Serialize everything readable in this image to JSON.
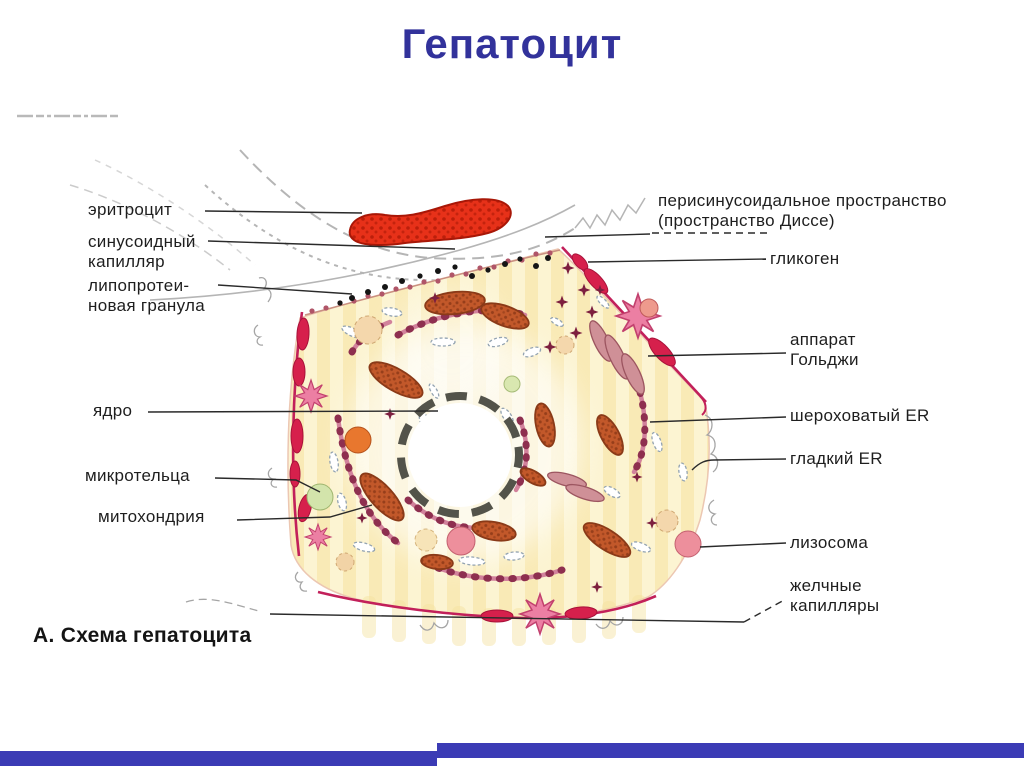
{
  "title": "Гепатоцит",
  "caption": "А. Схема гепатоцита",
  "labels": {
    "erythrocyte": "эритроцит",
    "sinusoid_capillary": "синусоидный\nкапилляр",
    "lipoprotein_granule": "липопротеи-\nновая гранула",
    "nucleus": "ядро",
    "microbodies": "микротельца",
    "mitochondria": "митохондрия",
    "perisinusoidal_space": "перисинусоидальное пространство\n(пространство Диссе)",
    "glycogen": "гликоген",
    "golgi_apparatus": "аппарат\nГольджи",
    "rough_er": "шероховатый ER",
    "smooth_er": "гладкий ER",
    "lysosome": "лизосома",
    "bile_capillaries": "желчные\nкапилляры"
  },
  "colors": {
    "title_blue": "#32329b",
    "footer_blue": "#3b3bb5",
    "label_ink": "#1e1e1e",
    "cell_fill": "#fcf4d2",
    "cell_stripe": "#f5e29e",
    "membrane_red": "#c2205a",
    "bile_red": "#d6204c",
    "erythrocyte_red": "#e73119",
    "mito_orange": "#c2582a",
    "mito_outline": "#8a3a18",
    "er_pink": "#d2829c",
    "er_dot": "#8e2f4f",
    "golgi_rose": "#cf9097",
    "nucleus_ring": "#53534a",
    "smooth_er_gray": "#93a3b1",
    "microbody_green": "#d3e4ab",
    "glycogen_maroon": "#7d1f3f",
    "star_pink": "#ec7fa3",
    "sinusoid_gray": "#b5b5b5",
    "dot_black": "#151515"
  }
}
